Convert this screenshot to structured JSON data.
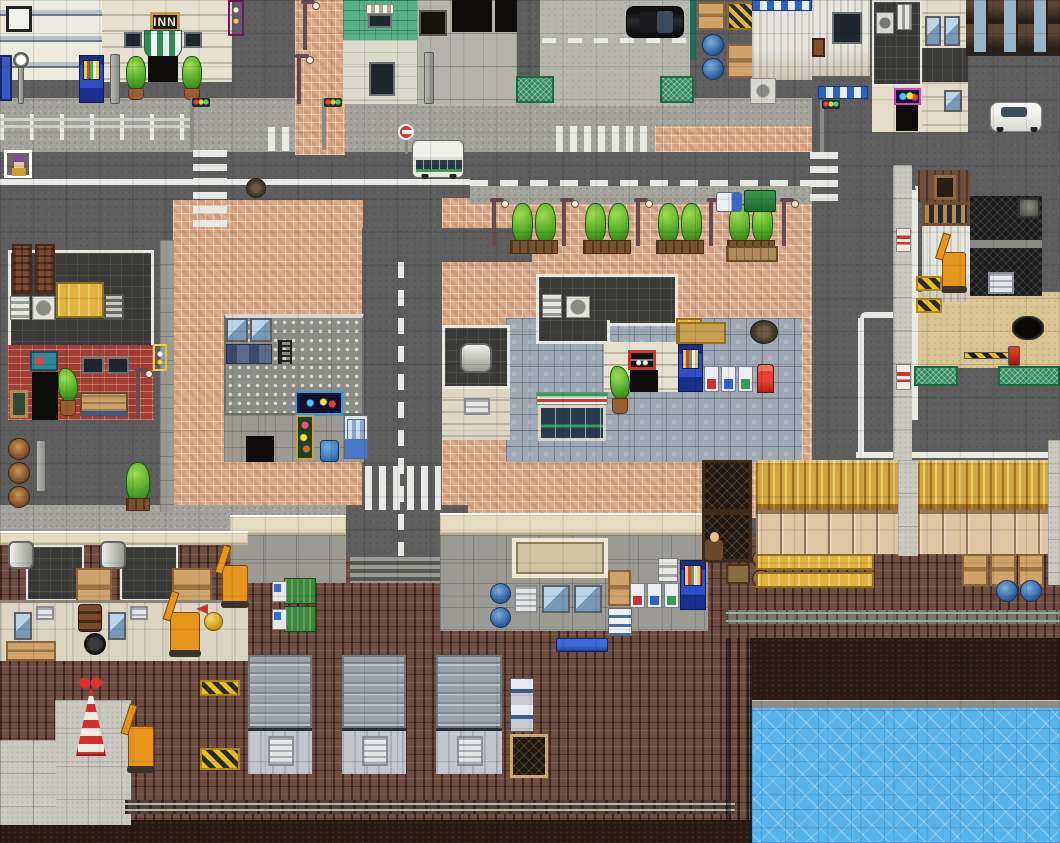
{
  "signs": {
    "inn": "INN"
  },
  "map": {
    "genre": "top-down RPG city map",
    "areas": [
      "downtown streets",
      "inn block",
      "brick shopping plaza",
      "convenience store",
      "restaurant block",
      "construction site",
      "warehouse district",
      "industrial dock",
      "waterfront"
    ]
  },
  "colors": {
    "road": "#5e5e5e",
    "sidewalk": "#a4a49c",
    "plaza_brick": "#d8ab8a",
    "dock_brick": "#6e4e42",
    "water": "#58b4ea",
    "sand": "#d9c493",
    "tree_green": "#55aa28",
    "awning_green": "#2f9e5b",
    "awning_red": "#d23c30",
    "machine_orange": "#e8951c",
    "vending_blue": "#2a50c8"
  },
  "entities": {
    "vehicles": [
      "minibus",
      "black-sedan",
      "white-sedan",
      "cargo-truck-1",
      "cargo-truck-2",
      "excavator-1",
      "excavator-2",
      "excavator-3",
      "excavator-4",
      "excavator-5"
    ],
    "npcs": [
      "player-event-marker",
      "dock-worker"
    ],
    "street_objects": [
      "vending-machines",
      "recycle-bins",
      "red-postbox",
      "stop-sign",
      "traffic-lights",
      "street-lamps",
      "guardrail",
      "manholes",
      "benches",
      "potted-plants",
      "street-trees",
      "barrels",
      "crates",
      "wrecking-ball",
      "derrick-tower",
      "safety-barriers",
      "green-fences"
    ]
  }
}
